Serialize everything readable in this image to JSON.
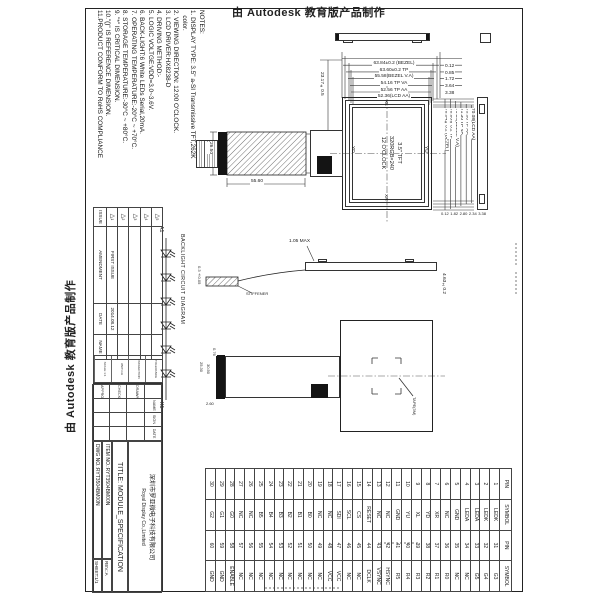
{
  "stamps": {
    "top": "由 Autodesk 教育版产品制作",
    "left": "由 Autodesk 教育版产品制作"
  },
  "notes": [
    "NOTES:",
    "1. DISPLAY TYPE: 3.5\" a-SI Transmissive TFT,262K",
    "   color.",
    "2. VIEWING DIRECTION: 12:00 O'CLOCK.",
    "3. LCD DRIVER:HX8238-D",
    "4. DRIVING METHOD:-",
    "5. LOGIC VOLTGE:VDD=3.0~3.6V.",
    "6. BACK-LIGHT:6 White LEDs Serial,20mA.",
    "7. OPERATING TEMPERATURE:-20°C ~ +70°C.",
    "8. STORAGE TEMPERATURE:-30°C ~ +80°C.",
    "9. \"*\" IS CRITICAL DIMENSION.",
    "10.\"()\" IS REFERENCE DIMENSION.",
    "11.PRODUCT CONFORM TO RoHS COMPLIANCE"
  ],
  "front_view": {
    "panel_label": [
      "3.5\" TFT",
      "320RGB×240",
      "12 O'CLOCK"
    ],
    "touch": {
      "top": "XL",
      "left": "YD",
      "right": "YU",
      "bottom": "XR"
    },
    "h_dims": [
      "63.84±0.2 (BEZEL)",
      "63.60±0.2 TP",
      "55.58(BEZEL V.A)",
      "54.16 TP VA",
      "52.56 TP AA",
      "52.36(LCD AA)"
    ],
    "h_offsets": [
      "0.12",
      "0.85",
      "1.72",
      "3.64",
      "3.38"
    ],
    "v_dims": [
      "76.84±0.2 (BEZEL)",
      "76.60±0.2 TP",
      "71.38(BEZEL V.A)",
      "71.30 TP VA",
      "70.08 TP AA",
      "70.08(LCD AA)"
    ],
    "v_offsets": [
      "0.12",
      "1.82",
      "2.80",
      "2.34",
      "3.38"
    ],
    "fpc_offset": "23.17±0.5",
    "fpc_width": "55.60",
    "fpc_height": "26.50"
  },
  "side_view": {
    "thickness": "4.63±0.2",
    "bump": "1.05 MAX",
    "stiffener": "STIFFENER",
    "fpc_thickness": "0.3±0.05"
  },
  "rear_view": {
    "fpc_length": "25.30",
    "fpc_length2": "30.50",
    "connector_height": "2.60",
    "connector_width": "0.76",
    "note": "TAPE(3M)"
  },
  "backlight": {
    "title": "BACKLIGHT CIRCUIT DIAGRAM",
    "anode": "A1",
    "cathode": "K1",
    "led_count": 6
  },
  "pin_table": {
    "headers": [
      "PIN",
      "SYMBOL",
      "PIN",
      "SYMBOL"
    ],
    "rows": [
      [
        "1",
        "LEDK",
        "31",
        "G3"
      ],
      [
        "2",
        "LEDK",
        "32",
        "G4"
      ],
      [
        "3",
        "LEDA",
        "33",
        "G5"
      ],
      [
        "4",
        "LEDA",
        "34",
        "NC"
      ],
      [
        "5",
        "GND",
        "35",
        "NC"
      ],
      [
        "6",
        "NC",
        "36",
        "R0"
      ],
      [
        "7",
        "XR",
        "37",
        "R1"
      ],
      [
        "8",
        "YD",
        "38",
        "R2"
      ],
      [
        "9",
        "XL",
        "39",
        "R3"
      ],
      [
        "10",
        "YU",
        "40",
        "R4"
      ],
      [
        "11",
        "GND",
        "41",
        "R5"
      ],
      [
        "12",
        "NC",
        "42",
        "HSYNC"
      ],
      [
        "13",
        "NC",
        "43",
        "VSYNC"
      ],
      [
        "14",
        "RESET",
        "44",
        "DCLK"
      ],
      [
        "15",
        "CS",
        "45",
        "NC"
      ],
      [
        "16",
        "SCL",
        "46",
        "NC"
      ],
      [
        "17",
        "SDI",
        "47",
        "VCC"
      ],
      [
        "18",
        "NC",
        "48",
        "VCC"
      ],
      [
        "19",
        "NC",
        "49",
        "NC"
      ],
      [
        "20",
        "B0",
        "50",
        "NC"
      ],
      [
        "21",
        "B1",
        "51",
        "NC"
      ],
      [
        "22",
        "B2",
        "52",
        "NC"
      ],
      [
        "23",
        "B3",
        "53",
        "NC"
      ],
      [
        "24",
        "B4",
        "54",
        "NC"
      ],
      [
        "25",
        "B5",
        "55",
        "NC"
      ],
      [
        "26",
        "NC",
        "56",
        "NC"
      ],
      [
        "27",
        "NC",
        "57",
        "NC"
      ],
      [
        "28",
        "G0",
        "58",
        "ENABLE"
      ],
      [
        "29",
        "G1",
        "59",
        "GND"
      ],
      [
        "30",
        "G2",
        "60",
        "GND"
      ]
    ]
  },
  "amendment": {
    "headers": [
      "ISSUE",
      "AMENDMENT",
      "DATE",
      "NAME"
    ],
    "rows": [
      [
        "1",
        "FIRST ISSUE",
        "2014.08.12",
        ""
      ],
      [
        "2",
        "",
        "",
        ""
      ],
      [
        "3",
        "",
        "",
        ""
      ],
      [
        "4",
        "",
        "",
        ""
      ],
      [
        "5",
        "",
        "",
        ""
      ]
    ],
    "micro": [
      "TOLERANCE",
      "PROJECTION",
      "UNIT:mm",
      "SCALE 1:1"
    ]
  },
  "title_block": {
    "sig_headers": [
      "NAME",
      "SIGN",
      "DATE"
    ],
    "sig_rows": [
      "DRAWN",
      "CHECKED",
      "APPROVED"
    ],
    "company_cn": "深圳市罗亚微电子科技有限公司",
    "company_en": "Royal Display Co.,Limited",
    "title_label": "TITLE:",
    "title": "MODULE_SPECIFICATION",
    "item_label": "ITEM NO.:",
    "item_no": "RYT3504BM00N",
    "rev_label": "REV.:",
    "rev": "A",
    "dwg_label": "DWG NO.:",
    "dwg_no": "RYT3504BM00N",
    "sheet_label": "SHEET:",
    "sheet": "1/1"
  }
}
